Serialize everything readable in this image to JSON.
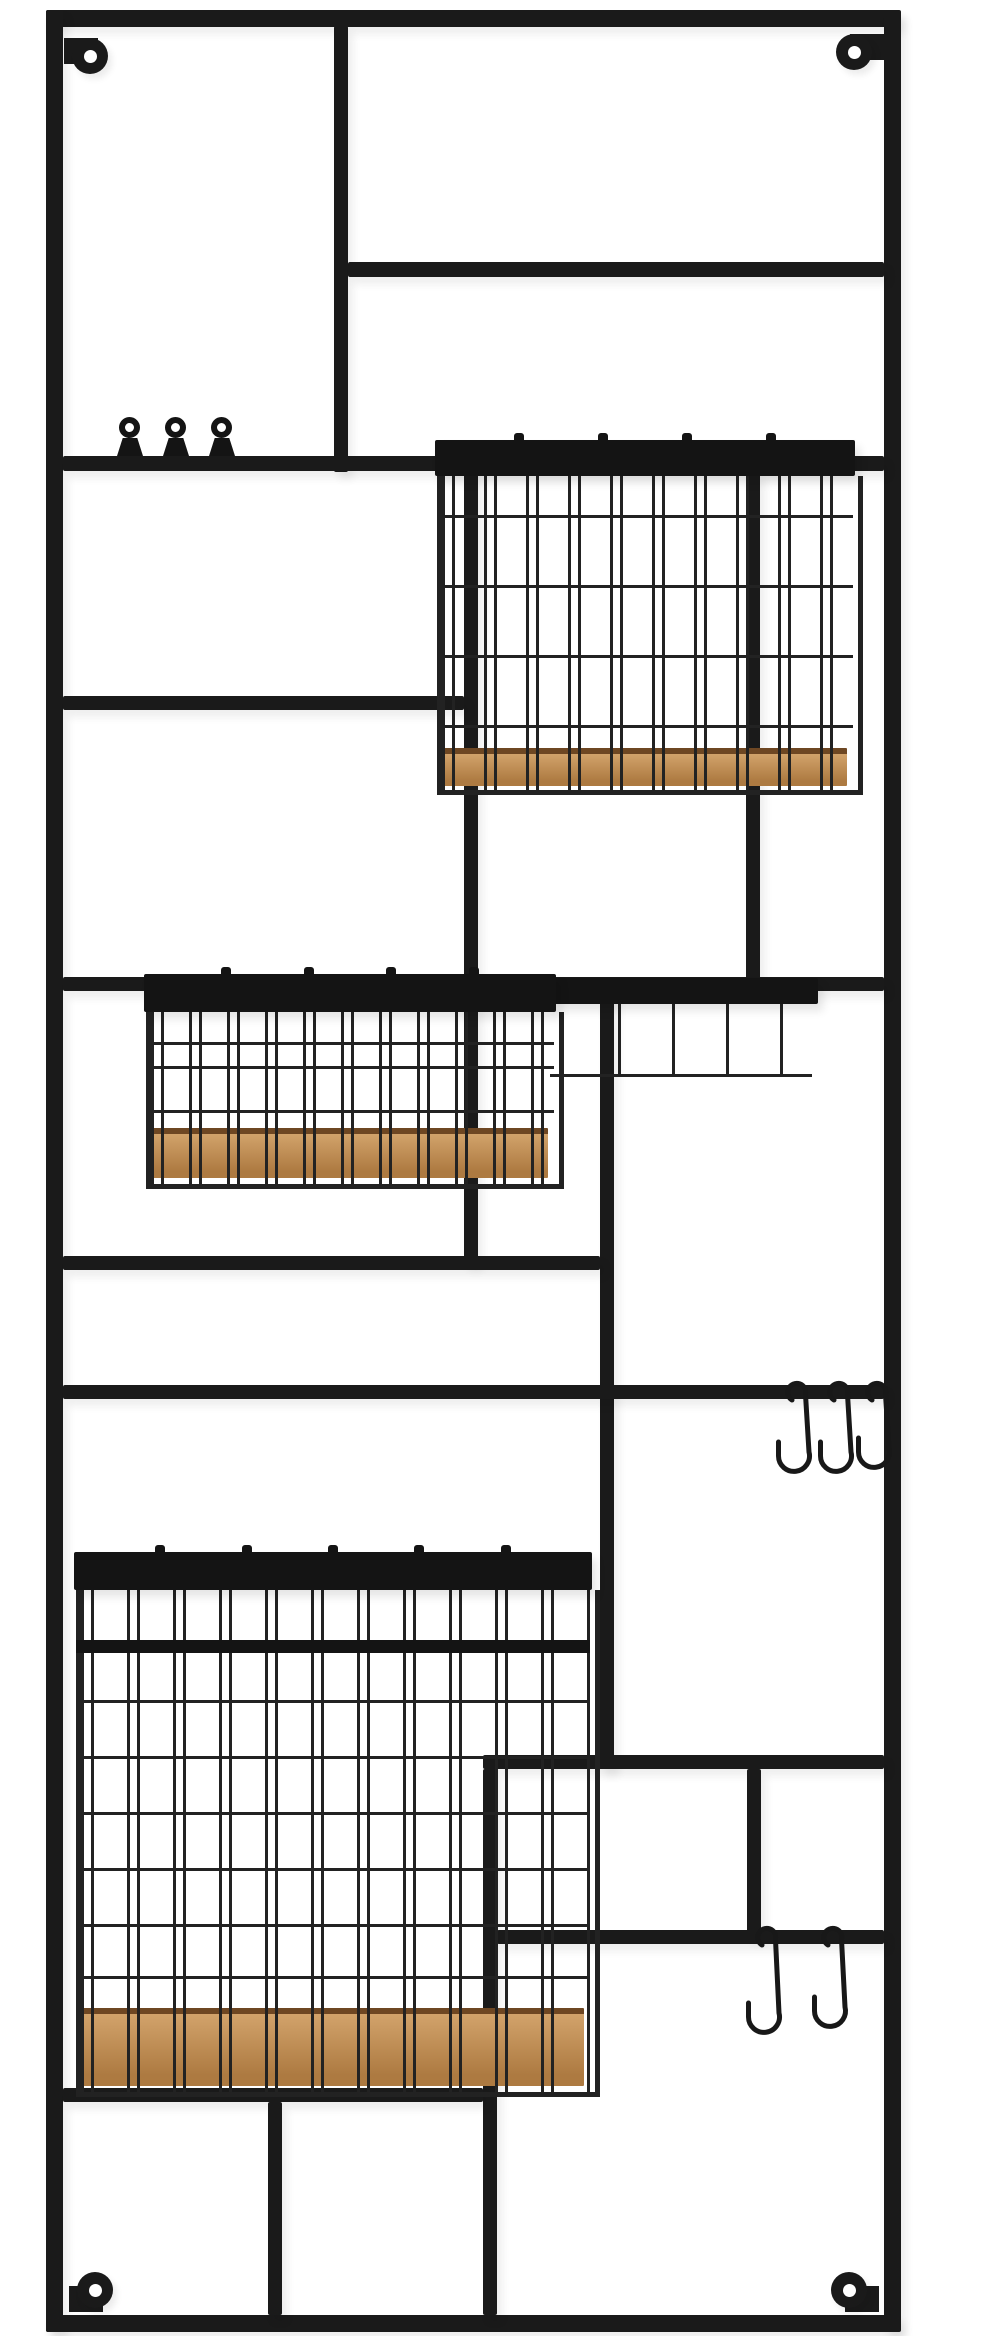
{
  "image_type": "product-photo",
  "subject": "Tall black metal wall-mounted grid organizer rack with three wood-base wire baskets, ring clips, S-hooks and corner screw tabs on a white background",
  "canvas": {
    "width": 984,
    "height": 2336
  },
  "colors": {
    "background": "#ffffff",
    "frame": "#1a1a1a",
    "rail": "#141414",
    "wire": "#222222",
    "hook": "#181818",
    "wood_light": "#d2a36b",
    "wood_dark": "#ad7a41",
    "wood_edge": "#6e4723"
  },
  "rack": {
    "bars": [
      {
        "name": "frame-top-bar",
        "x": 46,
        "y": 10,
        "w": 854,
        "h": 17
      },
      {
        "name": "frame-left-bar",
        "x": 46,
        "y": 10,
        "w": 17,
        "h": 2322
      },
      {
        "name": "frame-right-bar",
        "x": 884,
        "y": 10,
        "w": 17,
        "h": 2322
      },
      {
        "name": "frame-bottom-bar",
        "x": 46,
        "y": 2315,
        "w": 854,
        "h": 17
      },
      {
        "name": "divider-v1-top-center",
        "x": 334,
        "y": 26,
        "w": 14,
        "h": 446
      },
      {
        "name": "shelf-bar-top-right",
        "x": 348,
        "y": 262,
        "w": 536,
        "h": 15
      },
      {
        "name": "shelf-bar-clips-full",
        "x": 63,
        "y": 456,
        "w": 821,
        "h": 15
      },
      {
        "name": "divider-v2-center",
        "x": 464,
        "y": 471,
        "w": 14,
        "h": 793
      },
      {
        "name": "divider-v3-right",
        "x": 746,
        "y": 471,
        "w": 14,
        "h": 515
      },
      {
        "name": "shelf-bar-left-mid",
        "x": 63,
        "y": 696,
        "w": 401,
        "h": 14
      },
      {
        "name": "shelf-bar-basket2-full",
        "x": 63,
        "y": 977,
        "w": 821,
        "h": 14
      },
      {
        "name": "divider-v4-center-low",
        "x": 600,
        "y": 991,
        "w": 14,
        "h": 778
      },
      {
        "name": "shelf-bar-left-low",
        "x": 63,
        "y": 1256,
        "w": 537,
        "h": 14
      },
      {
        "name": "shelf-bar-hooks-full",
        "x": 63,
        "y": 1385,
        "w": 821,
        "h": 14
      },
      {
        "name": "shelf-bar-bottom-right-top",
        "x": 483,
        "y": 1755,
        "w": 401,
        "h": 14
      },
      {
        "name": "divider-v6-bottom-center",
        "x": 483,
        "y": 1769,
        "w": 14,
        "h": 546
      },
      {
        "name": "divider-v5-bottom-right",
        "x": 747,
        "y": 1769,
        "w": 14,
        "h": 168
      },
      {
        "name": "shelf-bar-hooks-lower",
        "x": 497,
        "y": 1930,
        "w": 387,
        "h": 14
      },
      {
        "name": "shelf-bar-bottom-left",
        "x": 63,
        "y": 2088,
        "w": 420,
        "h": 14
      },
      {
        "name": "divider-v7-bottom-left",
        "x": 268,
        "y": 2102,
        "w": 14,
        "h": 213
      }
    ],
    "mount_tabs": [
      {
        "name": "mount-tab-top-left",
        "cx": 90,
        "cy": 56,
        "link_dx": -22,
        "link_dy": -14
      },
      {
        "name": "mount-tab-top-right",
        "cx": 854,
        "cy": 52,
        "link_dx": 22,
        "link_dy": -14
      },
      {
        "name": "mount-tab-bottom-left",
        "cx": 95,
        "cy": 2290,
        "link_dx": -22,
        "link_dy": 14
      },
      {
        "name": "mount-tab-bottom-right",
        "cx": 849,
        "cy": 2290,
        "link_dx": 22,
        "link_dy": 14
      }
    ],
    "tab_size": 36,
    "tab_hole": 13,
    "clips": {
      "name": "ring-clip",
      "bar_top": 456,
      "centers_x": [
        130,
        176,
        222
      ],
      "ring_d": 22,
      "hole_d": 9,
      "base_w": 26,
      "base_h": 18
    },
    "baskets": [
      {
        "name": "basket-upper",
        "x": 435,
        "w": 420,
        "rail_y": 440,
        "rail_h": 36,
        "nubs": 4,
        "wood_y": 748,
        "wood_h": 32,
        "lip_h": 10,
        "rows_y": [
          515,
          585,
          655,
          725
        ],
        "rim_y": null,
        "wire_period": 42
      },
      {
        "name": "basket-middle",
        "x": 144,
        "w": 412,
        "rail_y": 974,
        "rail_h": 38,
        "nubs": 4,
        "wood_y": 1128,
        "wood_h": 44,
        "lip_h": 12,
        "rows_y": [
          1042,
          1066,
          1110
        ],
        "rim_y": null,
        "wire_period": 38,
        "side_ext": {
          "x2": 818,
          "bar_h": 26,
          "wires_x": [
            618,
            672,
            726,
            780
          ],
          "wires_bottom": 1074
        }
      },
      {
        "name": "basket-lower",
        "x": 74,
        "w": 518,
        "rail_y": 1552,
        "rail_h": 38,
        "nubs": 5,
        "wood_y": 2008,
        "wood_h": 72,
        "lip_h": 12,
        "rows_y": [
          1700,
          1756,
          1812,
          1868,
          1924,
          1976
        ],
        "rim_y": 1640,
        "wire_period": 46
      }
    ],
    "s_hooks": [
      {
        "name": "s-hook-upper-1",
        "cx": 800,
        "bar_y": 1385,
        "len": 112
      },
      {
        "name": "s-hook-upper-2",
        "cx": 842,
        "bar_y": 1385,
        "len": 112
      },
      {
        "name": "s-hook-upper-3",
        "cx": 880,
        "bar_y": 1385,
        "len": 108
      },
      {
        "name": "s-hook-lower-1",
        "cx": 770,
        "bar_y": 1930,
        "len": 128
      },
      {
        "name": "s-hook-lower-2",
        "cx": 836,
        "bar_y": 1930,
        "len": 122
      }
    ]
  }
}
